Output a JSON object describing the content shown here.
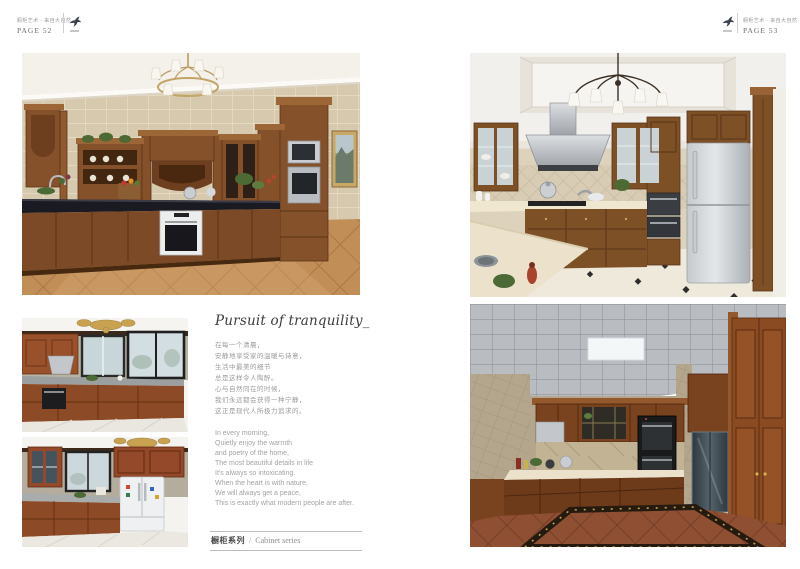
{
  "header_left": {
    "tagline": "橱柜艺术 · 来自大自然",
    "page": "PAGE 52"
  },
  "header_right": {
    "tagline": "橱柜艺术 · 来自大自然",
    "page": "PAGE 53"
  },
  "article": {
    "title": "Pursuit of tranquility_",
    "poem_cn": [
      "在每一个清晨，",
      "安静地享受家的温暖与诗意，",
      "生活中最美的细节",
      "总是这样令人陶醉。",
      "心与自然同在的时候，",
      "我们永远都会获得一种宁静，",
      "这正是现代人所极力追求的。"
    ],
    "poem_en": [
      "In every morning,",
      "Quietly enjoy the warmth",
      "and poetry of the home,",
      "The most beautiful details in life",
      "It's always so intoxicating.",
      "When the heart is with nature,",
      "We will always get a peace,",
      "This is exactly what modern people are after."
    ]
  },
  "footer": {
    "series_cn": "橱柜系列",
    "separator": "/",
    "series_en": "Cabinet series"
  },
  "photos": {
    "top_left": {
      "alt": "Classic walnut L-shaped kitchen with gold chandelier, beige tiled walls, black granite counter and built-in oven"
    },
    "top_right": {
      "alt": "Wood kitchen with white coffered ceiling, iron chandelier, stainless hood and silver refrigerator"
    },
    "mid_left_top": {
      "alt": "Red-brown kitchen with black framed windows, granite counter and built-in oven"
    },
    "mid_left_bottom": {
      "alt": "Red-brown kitchen with window and white double-door refrigerator"
    },
    "bottom_right": {
      "alt": "U-shaped wood kitchen with metal grid ceiling, black ovens and terracotta tiled floor"
    }
  },
  "colors": {
    "page_bg": "#ffffff",
    "rule_gray": "#bdbdbd",
    "text_gray": "#9b9b9b",
    "cabinet_wood": "#84512a",
    "logo_ink": "#39404c"
  }
}
